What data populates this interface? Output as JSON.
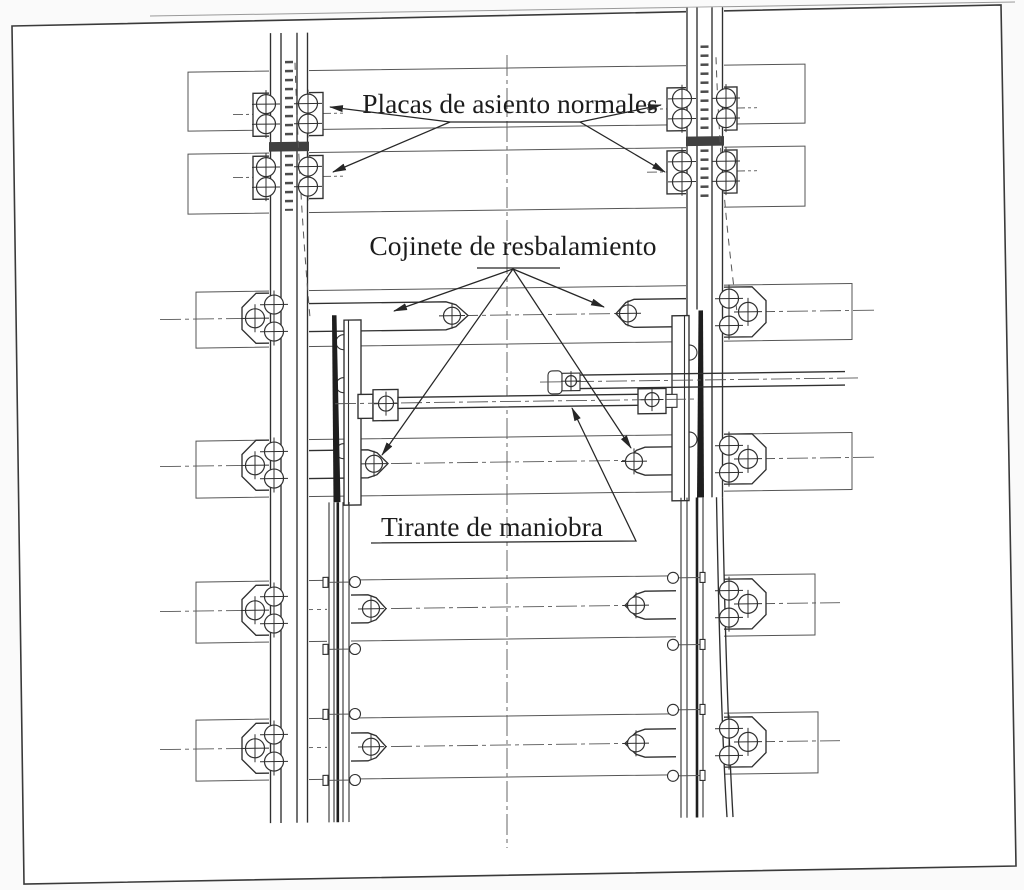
{
  "diagram": {
    "type": "technical-drawing",
    "subject": "railway-switch-plan-view",
    "labels": {
      "placas": "Placas de asiento normales",
      "cojinete": "Cojinete de resbalamiento",
      "tirante": "Tirante de maniobra"
    },
    "colors": {
      "ink": "#303030",
      "thin_line": "#565656",
      "paper": "#ffffff",
      "page_bg": "#fafafa",
      "blade_fill": "#1e1e1e",
      "joint_fill": "#404040",
      "label_ink": "#1c1c1c",
      "leader_ink": "#262626"
    },
    "components": {
      "sleepers": [
        {
          "x": 188,
          "y": 68,
          "w": 617,
          "h": 59
        },
        {
          "x": 188,
          "y": 150,
          "w": 617,
          "h": 60
        },
        {
          "x": 196,
          "y": 288,
          "w": 656,
          "h": 56
        },
        {
          "x": 196,
          "y": 437,
          "w": 656,
          "h": 57
        },
        {
          "x": 196,
          "y": 578,
          "w": 619,
          "h": 61
        },
        {
          "x": 196,
          "y": 716,
          "w": 622,
          "h": 61
        }
      ],
      "row_centerlines": [
        {
          "y": 315,
          "x1": 160,
          "x2": 878
        },
        {
          "y": 462,
          "x1": 160,
          "x2": 878
        },
        {
          "y": 607,
          "x1": 160,
          "x2": 840
        },
        {
          "y": 745,
          "x1": 160,
          "x2": 840
        }
      ],
      "plate_centerlines": [
        {
          "y": 111,
          "segs": [
            [
              233,
              255
            ],
            [
              321,
              343
            ],
            [
              647,
              669
            ],
            [
              735,
              757
            ]
          ]
        },
        {
          "y": 174,
          "segs": [
            [
              233,
              255
            ],
            [
              321,
              343
            ],
            [
              647,
              669
            ],
            [
              735,
              757
            ]
          ]
        }
      ],
      "base_plates": [
        {
          "x": 253,
          "y": 90,
          "w": 70,
          "h": 43,
          "bolts": [
            [
              266,
              101
            ],
            [
              266,
              121
            ],
            [
              308,
              101
            ],
            [
              308,
              121
            ]
          ]
        },
        {
          "x": 253,
          "y": 153,
          "w": 70,
          "h": 43,
          "bolts": [
            [
              266,
              164
            ],
            [
              266,
              184
            ],
            [
              308,
              164
            ],
            [
              308,
              184
            ]
          ]
        },
        {
          "x": 667,
          "y": 90,
          "w": 70,
          "h": 43,
          "bolts": [
            [
              682,
              101
            ],
            [
              682,
              121
            ],
            [
              726,
              101
            ],
            [
              726,
              121
            ]
          ]
        },
        {
          "x": 667,
          "y": 153,
          "w": 70,
          "h": 43,
          "bolts": [
            [
              682,
              164
            ],
            [
              682,
              184
            ],
            [
              726,
              164
            ],
            [
              726,
              184
            ]
          ]
        }
      ],
      "outer_chairs": [
        {
          "side": "left",
          "cy": 315
        },
        {
          "side": "left",
          "cy": 462
        },
        {
          "side": "left",
          "cy": 607
        },
        {
          "side": "left",
          "cy": 745
        },
        {
          "side": "right",
          "cy": 315
        },
        {
          "side": "right",
          "cy": 462
        },
        {
          "side": "right",
          "cy": 607
        },
        {
          "side": "right",
          "cy": 745
        }
      ],
      "slide_plates": [
        {
          "rect": [
            300,
            301,
            146,
            28
          ],
          "cap": "right",
          "tip": 468,
          "bolt": [
            452,
            315
          ]
        },
        {
          "rect": [
            300,
            448,
            68,
            28
          ],
          "cap": "right",
          "tip": 388,
          "bolt": [
            374,
            462
          ]
        },
        {
          "rect": [
            340,
            593,
            28,
            28
          ],
          "cap": "right",
          "tip": 386,
          "bolt": [
            371,
            607
          ]
        },
        {
          "rect": [
            340,
            731,
            28,
            28
          ],
          "cap": "right",
          "tip": 386,
          "bolt": [
            371,
            745
          ]
        },
        {
          "rect": [
            634,
            301,
            56,
            28
          ],
          "cap": "left",
          "tip": 616,
          "bolt": [
            628,
            315
          ]
        },
        {
          "rect": [
            645,
            449,
            43,
            28
          ],
          "cap": "left",
          "tip": 626,
          "bolt": [
            634,
            463
          ]
        },
        {
          "rect": [
            645,
            593,
            45,
            28
          ],
          "cap": "left",
          "tip": 625,
          "bolt": [
            636,
            607
          ]
        },
        {
          "rect": [
            645,
            731,
            45,
            28
          ],
          "cap": "left",
          "tip": 625,
          "bolt": [
            636,
            745
          ]
        }
      ],
      "blade_bolt_ys": [
        580,
        647,
        712,
        778
      ],
      "rod_bolts": [
        [
          386,
          402,
          7.5
        ],
        [
          652,
          401.5,
          7
        ],
        [
          571,
          382,
          5.5
        ]
      ],
      "label_fan_segments": [
        {
          "x1": 450,
          "y1": 122,
          "x2": 580,
          "y2": 122
        },
        {
          "x1": 477,
          "y1": 268,
          "x2": 560,
          "y2": 268
        }
      ],
      "leaders": [
        {
          "pts": [
            [
              450,
              122
            ],
            [
              330,
              107
            ]
          ],
          "arrow": true
        },
        {
          "pts": [
            [
              450,
              122
            ],
            [
              333,
              172
            ]
          ],
          "arrow": true
        },
        {
          "pts": [
            [
              580,
              122
            ],
            [
              661,
              105
            ]
          ],
          "arrow": true
        },
        {
          "pts": [
            [
              580,
              122
            ],
            [
              665,
              172
            ]
          ],
          "arrow": true
        },
        {
          "pts": [
            [
              513,
              269
            ],
            [
              394,
              311
            ]
          ],
          "arrow": true
        },
        {
          "pts": [
            [
              513,
              269
            ],
            [
              604,
              307
            ]
          ],
          "arrow": true
        },
        {
          "pts": [
            [
              513,
              269
            ],
            [
              382,
              455
            ]
          ],
          "arrow": true
        },
        {
          "pts": [
            [
              513,
              269
            ],
            [
              631,
              448
            ]
          ],
          "arrow": true
        },
        {
          "pts": [
            [
              371,
              543
            ],
            [
              636,
              541
            ],
            [
              572,
              408
            ]
          ],
          "arrow": true
        }
      ]
    }
  }
}
